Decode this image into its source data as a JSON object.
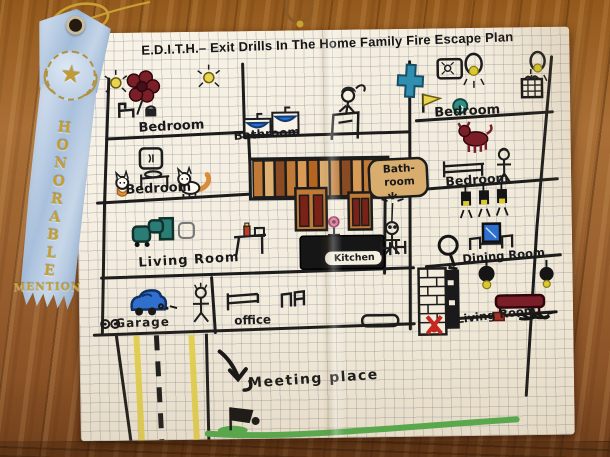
{
  "title": "E.D.I.T.H.– Exit Drills In The Home Family Fire Escape Plan",
  "ribbon": {
    "line1": "HONORABLE",
    "line2": "MENTION",
    "star": "★"
  },
  "plan": {
    "rooms": [
      {
        "id": "bedroom-top-left",
        "label": "Bedroom"
      },
      {
        "id": "bathroom-top",
        "label": "Bathroom"
      },
      {
        "id": "bedroom-top-right",
        "label": "Bedroom"
      },
      {
        "id": "bedroom-mid-left",
        "label": "Bedroom"
      },
      {
        "id": "bathroom-center",
        "label": "Bath-\nroom"
      },
      {
        "id": "bedroom-mid-right",
        "label": "Bedroom"
      },
      {
        "id": "living-room-left",
        "label": "Living Room"
      },
      {
        "id": "kitchen",
        "label": "Kitchen"
      },
      {
        "id": "dining-room",
        "label": "Dining Room"
      },
      {
        "id": "living-room-right",
        "label": "Living Room"
      },
      {
        "id": "garage",
        "label": "Garage"
      },
      {
        "id": "office",
        "label": "office"
      },
      {
        "id": "meeting-place",
        "label": "Meeting place"
      }
    ]
  },
  "colors": {
    "paper": "#f4edde",
    "grid": "#7d8494",
    "marker_black": "#1c1c1c",
    "wood_brown": "#9c6230",
    "ribbon_blue": "#a9c0dc",
    "award_gold": "#c49f33",
    "stairs_brown": "#c07a36",
    "cabinet_dark_red": "#7a2217",
    "road_yellow": "#e6d44e",
    "grass_green": "#55ae4e",
    "water_blue": "#2d6fd1",
    "couch_teal": "#2a7d74",
    "dark_red": "#7a1f28"
  }
}
